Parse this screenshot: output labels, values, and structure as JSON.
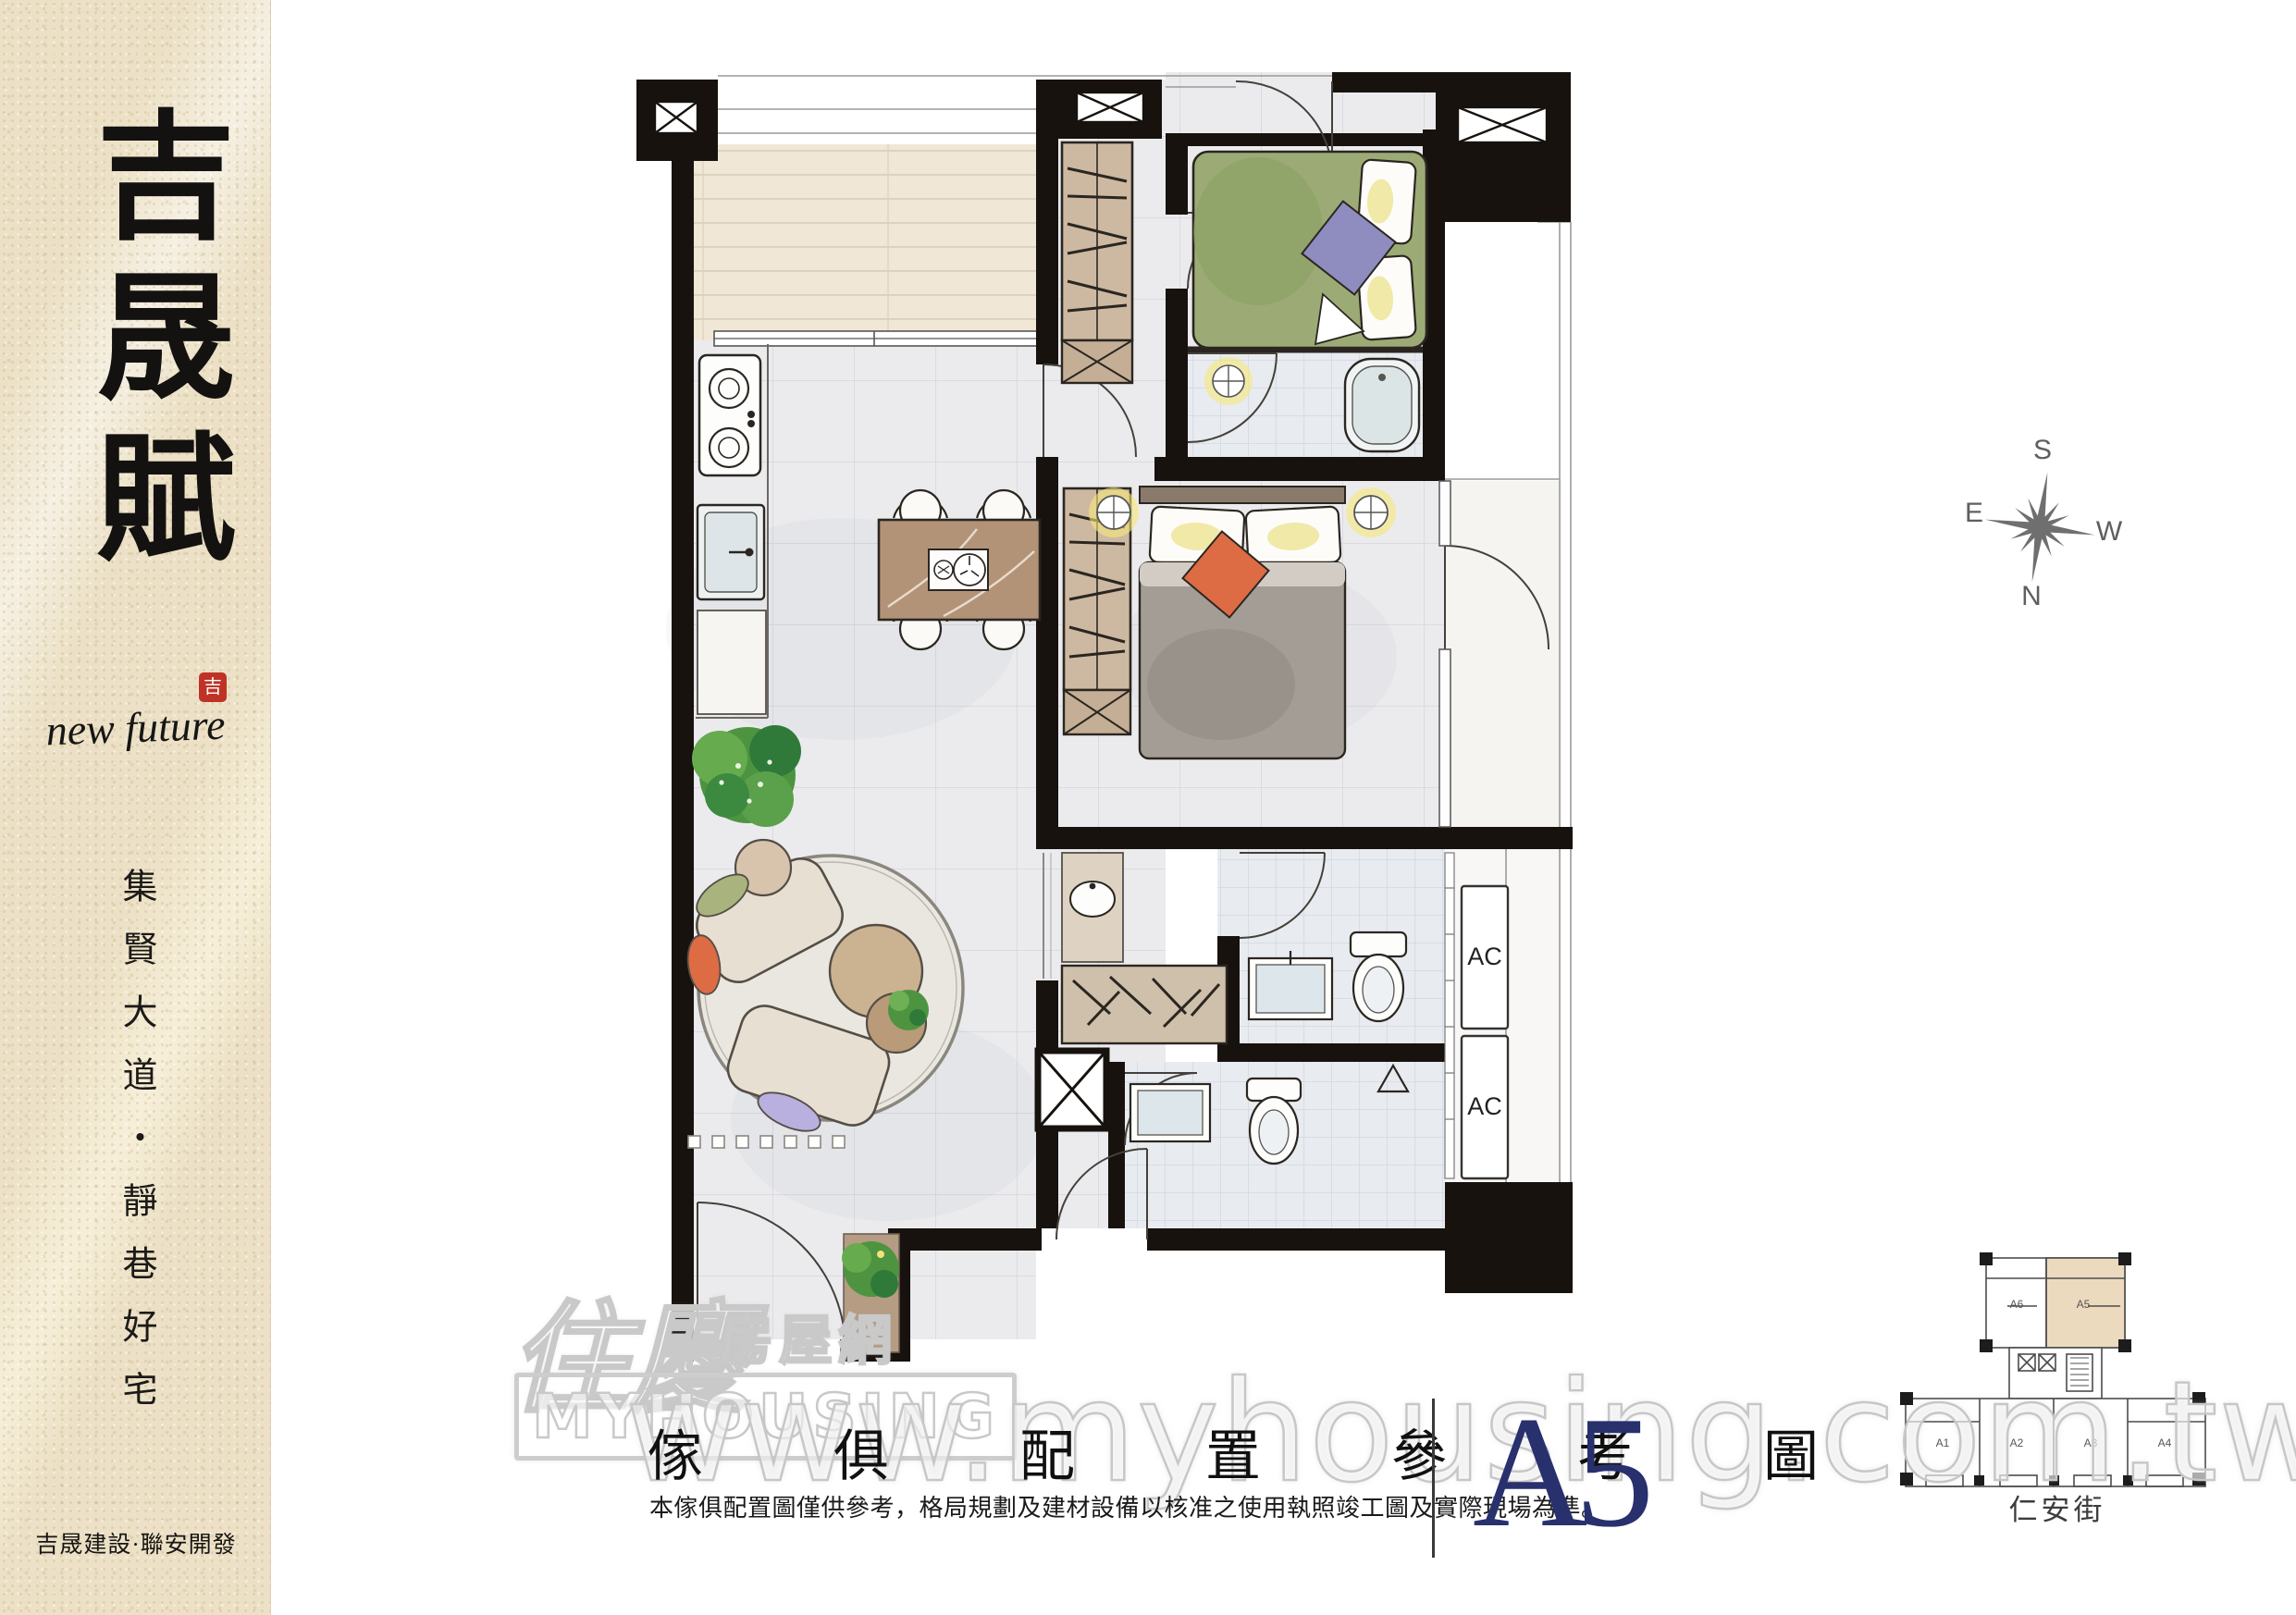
{
  "sidebar": {
    "brand": "吉晟賦",
    "seal_char": "吉",
    "script_text": "new future",
    "tagline": "集賢大道・靜巷好宅",
    "developer": "吉晟建設·聯安開發"
  },
  "plan": {
    "ac_label": "AC"
  },
  "compass": {
    "top": "S",
    "left": "E",
    "right": "W",
    "bottom": "N"
  },
  "keyplan": {
    "street_label": "仁安街",
    "units": [
      "A1",
      "A2",
      "A3",
      "A4",
      "A5",
      "A6"
    ],
    "highlighted_unit": "A5",
    "highlight_color": "#ecdabf"
  },
  "footer": {
    "title": "傢 俱 配 置 參 考 圖",
    "unit_label": "A5",
    "unit_color": "#28306d",
    "disclaimer": "本傢俱配置圖僅供參考，格局規劃及建材設備以核准之使用執照竣工圖及實際現場為準。"
  },
  "watermark": {
    "url_text": "www.myhousing.com.tw",
    "logo_main": "住慶",
    "logo_sub": "房屋網",
    "logo_en": "MYHOUSING"
  },
  "colors": {
    "wall": "#17120e",
    "bed_green": "#9cab76",
    "cushion_purple": "#8f8cc0",
    "cushion_orange": "#dd6b44",
    "wood_tan": "#b39378",
    "seal_red": "#bf3226"
  }
}
